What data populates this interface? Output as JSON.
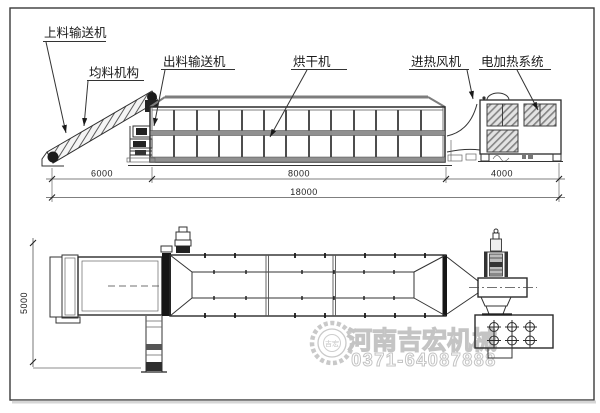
{
  "labels": {
    "feed_conveyor": "上料输送机",
    "leveling_mechanism": "均料机构",
    "discharge_conveyor": "出料输送机",
    "dryer": "烘干机",
    "hot_air_blower": "进热风机",
    "electric_heating_system": "电加热系统"
  },
  "dimensions": {
    "feed_section_length": "6000",
    "dryer_section_length": "8000",
    "heater_section_length": "4000",
    "total_length": "18000",
    "overall_width": "5000"
  },
  "watermark": {
    "company": "河南吉宏机械",
    "phone": "0371-64087888",
    "logo_text": "吉宏"
  },
  "colors": {
    "line": "#333333",
    "dark_fill": "#1a1a1a",
    "rail_gray": "#909090",
    "hatch_gray": "#858585",
    "watermark_gray": "#c6c6c6"
  }
}
